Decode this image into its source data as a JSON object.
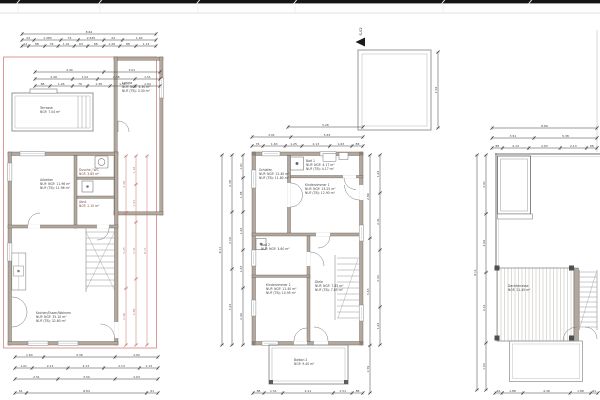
{
  "marker": {
    "label": "S-02"
  },
  "colors": {
    "wall_fill": "#b3a89e",
    "wall_edge": "#5f574e",
    "line": "#3c3c3c",
    "red_overlay": "#c4736d",
    "band": "#161616"
  },
  "rooms": {
    "left": {
      "terrasse": {
        "name": "Terrasse",
        "area": "NGF: 7.04 m²"
      },
      "loggia": {
        "name": "Loggia",
        "area1": "NUF: NGF: 3.30 m²",
        "area2": "NUF (TB): 3.30 m²"
      },
      "arbeiten": {
        "name": "Arbeiten",
        "area1": "NUF: NGF: 11.96 m²",
        "area2": "NUF (TB): 11.96 m²"
      },
      "wc": {
        "name": "Dusche / WC",
        "area": "NGF: 3.85 m²"
      },
      "abstell": {
        "name": "Abst.",
        "area": "NGF: 2.10 m²"
      },
      "wohnen": {
        "name": "Kochen/Essen/Wohnen",
        "area1": "NUF: NGF: 35.10 m²",
        "area2": "NUF (TB): 32.60 m²"
      }
    },
    "middle": {
      "schlafen": {
        "name": "Schlafen",
        "area1": "NUF: NGF: 12.40 m²",
        "area2": "NUF (TB): 11.80 m²"
      },
      "bad1": {
        "name": "Bad 1",
        "area1": "NUF: NGF: 4.17 m²",
        "area2": "NUF (TB): 4.17 m²"
      },
      "kind1": {
        "name": "Kinderzimmer 1",
        "area1": "NUF: NGF: 13.25 m²",
        "area2": "NUF (TB): 12.90 m²"
      },
      "bad2": {
        "name": "Bad 2",
        "area": "NUF: NGF: 3.60 m²"
      },
      "kind2": {
        "name": "Kinderzimmer 2",
        "area1": "NUF: NGF: 11.40 m²",
        "area2": "NUF (TB): 10.95 m²"
      },
      "diele": {
        "name": "Diele",
        "area1": "NUF: NGF: 7.85 m²",
        "area2": "NUF (TB): 7.85 m²"
      },
      "balkon": {
        "name": "Balkon 2",
        "area": "NGF: 9.40 m²"
      }
    },
    "right": {
      "dachterrasse": {
        "name": "Dachterrasse",
        "area": "NGF: 21.40 m²"
      }
    }
  },
  "dims": [
    {
      "o": "h",
      "x": 22,
      "y": 34,
      "len": 134,
      "segs": [
        1
      ],
      "labels": [
        "8.64"
      ]
    },
    {
      "o": "h",
      "x": 22,
      "y": 40,
      "len": 134,
      "segs": [
        0.09,
        0.2,
        0.13,
        0.19,
        0.14,
        0.25
      ],
      "labels": [
        "24",
        "1.385",
        "74",
        "2.635",
        "24",
        "1.93"
      ]
    },
    {
      "o": "h",
      "x": 22,
      "y": 46,
      "len": 134,
      "segs": [
        0.05,
        0.12,
        0.1,
        0.12,
        0.1,
        0.12,
        0.12,
        0.12,
        0.15
      ],
      "labels": [
        "14",
        "88",
        "76",
        "1.01",
        "63",
        "88",
        "1.26",
        "88",
        "1.13"
      ]
    },
    {
      "o": "h",
      "x": 35,
      "y": 72,
      "len": 125,
      "segs": [
        0.55,
        0.45
      ],
      "labels": [
        "4.44",
        "3.01"
      ]
    },
    {
      "o": "h",
      "x": 35,
      "y": 79,
      "len": 125,
      "segs": [
        0.3,
        0.2,
        0.3,
        0.2
      ],
      "labels": [
        "2.26",
        "1.01",
        "2.38",
        "1.51"
      ]
    },
    {
      "o": "h",
      "x": 35,
      "y": 86,
      "len": 125,
      "segs": [
        0.12,
        0.18,
        0.12,
        0.18,
        0.2,
        0.2
      ],
      "labels": [
        "88",
        "1.26",
        "76",
        "1.38",
        "1.51",
        "1.64"
      ]
    },
    {
      "o": "h",
      "x": 15,
      "y": 357,
      "len": 143,
      "segs": [
        0.2,
        0.5,
        0.3
      ],
      "labels": [
        "1.64",
        "4.38",
        "2.62"
      ]
    },
    {
      "o": "h",
      "x": 15,
      "y": 368,
      "len": 143,
      "segs": [
        0.12,
        0.25,
        0.25,
        0.25,
        0.13
      ],
      "labels": [
        "1.01",
        "2.13",
        "2.13",
        "2.13",
        "1.13"
      ]
    },
    {
      "o": "h",
      "x": 15,
      "y": 379,
      "len": 143,
      "segs": [
        0.3,
        0.4,
        0.3
      ],
      "labels": [
        "2.51",
        "3.50",
        "2.63"
      ]
    },
    {
      "o": "h",
      "x": 15,
      "y": 393,
      "len": 143,
      "segs": [
        0.08,
        0.84,
        0.08
      ],
      "labels": [
        "61",
        "8.64",
        "61"
      ]
    },
    {
      "o": "v",
      "x": 126,
      "y": 156,
      "len": 189,
      "segs": [
        0.3,
        0.4,
        0.3
      ],
      "labels": [
        "2.38",
        "3.25",
        "2.48"
      ],
      "c": "#c4736d"
    },
    {
      "o": "v",
      "x": 136,
      "y": 156,
      "len": 189,
      "segs": [
        0.15,
        0.2,
        0.3,
        0.35
      ],
      "labels": [
        "1.18",
        "1.63",
        "2.41",
        "2.89"
      ],
      "c": "#c4736d"
    },
    {
      "o": "v",
      "x": 147,
      "y": 156,
      "len": 189,
      "segs": [
        1
      ],
      "labels": [
        "8.11"
      ],
      "c": "#c4736d"
    },
    {
      "o": "v",
      "x": 438,
      "y": 52,
      "len": 76,
      "segs": [
        1
      ],
      "labels": [
        "2.56"
      ]
    },
    {
      "o": "h",
      "x": 288,
      "y": 127,
      "len": 75,
      "segs": [
        1
      ],
      "labels": [
        "5.26"
      ]
    },
    {
      "o": "h",
      "x": 252,
      "y": 137,
      "len": 111,
      "segs": [
        0.35,
        0.65
      ],
      "labels": [
        "3.01",
        "5.63"
      ]
    },
    {
      "o": "h",
      "x": 252,
      "y": 146,
      "len": 111,
      "segs": [
        0.1,
        0.2,
        0.15,
        0.25,
        0.2,
        0.1
      ],
      "labels": [
        "76",
        "1.63",
        "1.25",
        "2.13",
        "1.63",
        "88"
      ]
    },
    {
      "o": "v",
      "x": 222,
      "y": 155,
      "len": 190,
      "segs": [
        1
      ],
      "labels": [
        "8.11"
      ]
    },
    {
      "o": "v",
      "x": 232,
      "y": 155,
      "len": 190,
      "segs": [
        0.3,
        0.3,
        0.4
      ],
      "labels": [
        "2.38",
        "2.50",
        "3.23"
      ]
    },
    {
      "o": "v",
      "x": 243,
      "y": 155,
      "len": 190,
      "segs": [
        0.12,
        0.18,
        0.2,
        0.2,
        0.3
      ],
      "labels": [
        "1.01",
        "1.38",
        "1.63",
        "1.63",
        "2.46"
      ]
    },
    {
      "o": "v",
      "x": 370,
      "y": 155,
      "len": 238,
      "segs": [
        0.35,
        0.45,
        0.2
      ],
      "labels": [
        "2.89",
        "3.63",
        "1.59"
      ]
    },
    {
      "o": "v",
      "x": 380,
      "y": 155,
      "len": 190,
      "segs": [
        0.2,
        0.3,
        0.3,
        0.2
      ],
      "labels": [
        "1.63",
        "2.41",
        "2.44",
        "1.63"
      ]
    },
    {
      "o": "h",
      "x": 253,
      "y": 393,
      "len": 110,
      "segs": [
        0.1,
        0.17,
        0.46,
        0.17,
        0.1
      ],
      "labels": [
        "88",
        "1.51",
        "4.11",
        "1.51",
        "88"
      ]
    },
    {
      "o": "h",
      "x": 492,
      "y": 128,
      "len": 105,
      "segs": [
        1
      ],
      "labels": [
        "8.89"
      ]
    },
    {
      "o": "h",
      "x": 492,
      "y": 138,
      "len": 105,
      "segs": [
        0.4,
        0.6
      ],
      "labels": [
        "3.51",
        "5.38"
      ]
    },
    {
      "o": "h",
      "x": 492,
      "y": 148,
      "len": 105,
      "segs": [
        0.1,
        0.25,
        0.3,
        0.25,
        0.1
      ],
      "labels": [
        "88",
        "2.13",
        "2.63",
        "2.13",
        "88"
      ]
    },
    {
      "o": "v",
      "x": 477,
      "y": 155,
      "len": 235,
      "segs": [
        1
      ],
      "labels": [
        "8.11"
      ]
    },
    {
      "o": "v",
      "x": 486,
      "y": 155,
      "len": 235,
      "segs": [
        0.25,
        0.25,
        0.3,
        0.2
      ],
      "labels": [
        "2.01",
        "2.06",
        "2.41",
        "1.63"
      ]
    },
    {
      "o": "h",
      "x": 495,
      "y": 393,
      "len": 103,
      "segs": [
        0.07,
        0.2,
        0.46,
        0.2,
        0.07
      ],
      "labels": [
        "61",
        "1.88",
        "4.36",
        "1.88",
        "61"
      ]
    }
  ]
}
